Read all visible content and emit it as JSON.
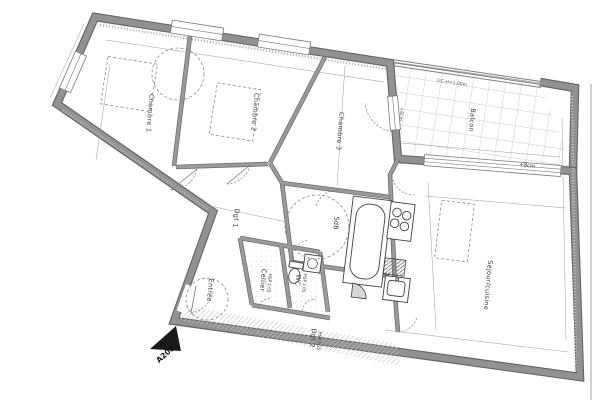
{
  "plan": {
    "chambre1": {
      "name": "Chambre 1"
    },
    "chambre2": {
      "name": "Chambre 2"
    },
    "chambre3": {
      "name": "Chambre 3"
    },
    "balcon": {
      "name": "Balcon"
    },
    "sejour_cuisine": {
      "name": "Séjour/cuisine"
    },
    "sdb": {
      "name": "SdB"
    },
    "wc": {
      "name": "WC",
      "ceiling": "HSP 2.05"
    },
    "cellier": {
      "name": "Cellier",
      "ceiling": "HSP 2.05"
    },
    "entree": {
      "name": "Entrée"
    },
    "dgt1": {
      "name": "Dgt 1"
    },
    "dgt2": {
      "name": "Dgt 2",
      "ceiling": "HSP 2.25"
    }
  },
  "annotations": {
    "guardrail": "GC H=1.00m",
    "level_offset_balcony": "+8cm",
    "level_offset_door": "+8cm",
    "unit_reference": "A208"
  },
  "colors": {
    "wall_fill": "#929292",
    "wall_edge": "#656565",
    "line": "#3f3f3f",
    "tile_grid": "#b5bcc2",
    "hatch": "#c2c2c2",
    "background": "#ffffff"
  }
}
